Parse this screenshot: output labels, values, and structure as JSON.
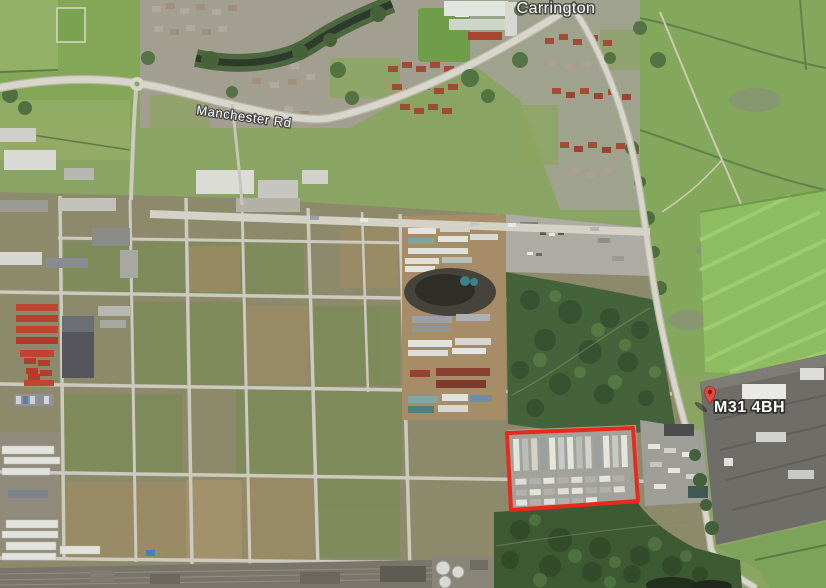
{
  "map": {
    "view_type": "satellite-aerial",
    "place_label": "Carrington",
    "road_label": "Manchester Rd",
    "marker": {
      "label": "M31 4BH",
      "pin_color": "#e8453c"
    },
    "highlight": {
      "name": "site-boundary",
      "stroke_color": "#e8291c",
      "stroke_width": "4",
      "points": "507,433 633,428 638,501 511,510"
    },
    "palette": {
      "field_green": "#84a757",
      "bright_field_green": "#8ebd61",
      "woodland_green": "#45633a",
      "brownfield_olive": "#8c8a6b",
      "road_gray": "#d8d5cb",
      "pavement_gray": "#a2a19a",
      "river_dark": "#2c3b2a"
    }
  }
}
